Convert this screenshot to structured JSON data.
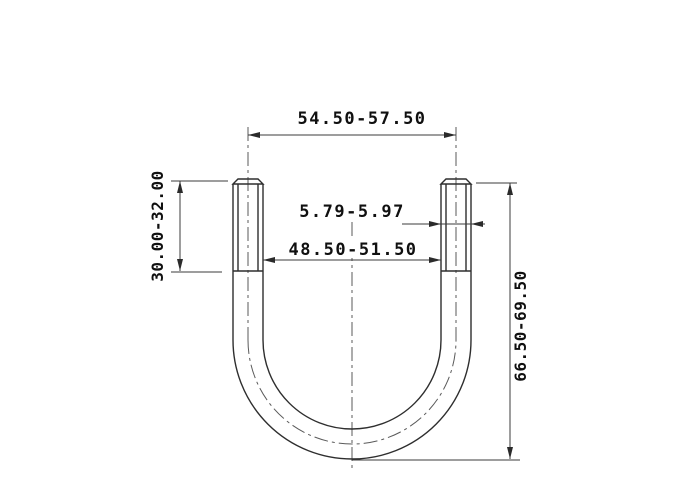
{
  "drawing": {
    "type": "u-bolt-dimension-drawing",
    "dimensions": {
      "center_width": "54.50-57.50",
      "rod_diameter": "5.79-5.97",
      "inner_width": "48.50-51.50",
      "thread_length": "30.00-32.00",
      "total_height": "66.50-69.50"
    },
    "colors": {
      "background": "#ffffff",
      "object_line": "#2e2e2e",
      "dimension_line": "#3b3b3b",
      "centerline": "#5a5a5a",
      "text": "#101010"
    }
  }
}
